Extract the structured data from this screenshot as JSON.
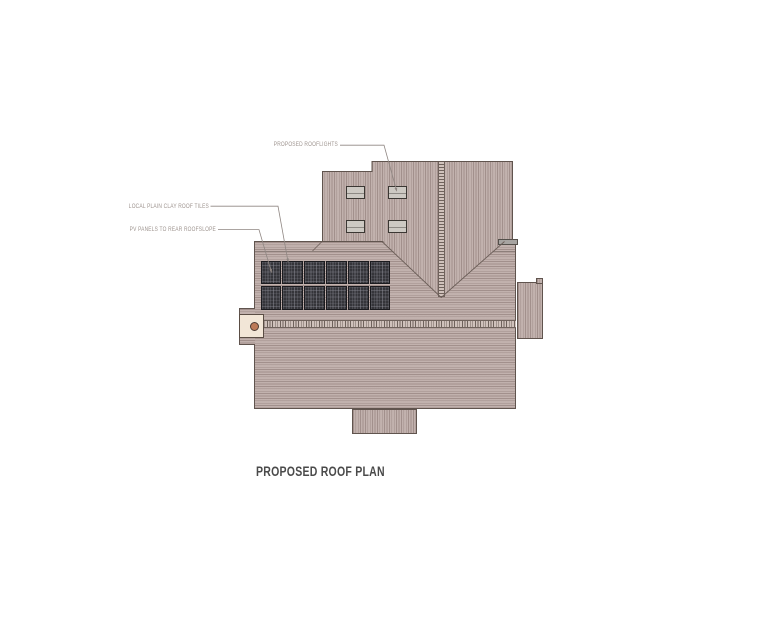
{
  "page": {
    "background_color": "#ffffff"
  },
  "drawing": {
    "title": "PROPOSED ROOF PLAN",
    "annotations": [
      {
        "id": "rooflights",
        "label": "PROPOSED ROOFLIGHTS"
      },
      {
        "id": "clay-tiles",
        "label": "LOCAL PLAIN CLAY ROOF TILES"
      },
      {
        "id": "pv-panels",
        "label": "PV PANELS TO REAR ROOFSLOPE"
      }
    ],
    "features": {
      "rooflight_count": 4,
      "pv_panel_columns": 6,
      "pv_panel_rows": 2,
      "chimney_count": 1
    },
    "colors": {
      "roof_tile_light": "#c2b2ae",
      "roof_tile_dark": "#a2908c",
      "ridge_detail": "#6f625c",
      "outline": "#60544e",
      "pv_panel": "#35353a",
      "rooflight_glass": "#cdc9c3",
      "chimney_body": "#f2e6d7",
      "chimney_pot": "#bd7a58",
      "annotation_text": "#9d938e",
      "title_text": "#4a4a4a"
    }
  }
}
